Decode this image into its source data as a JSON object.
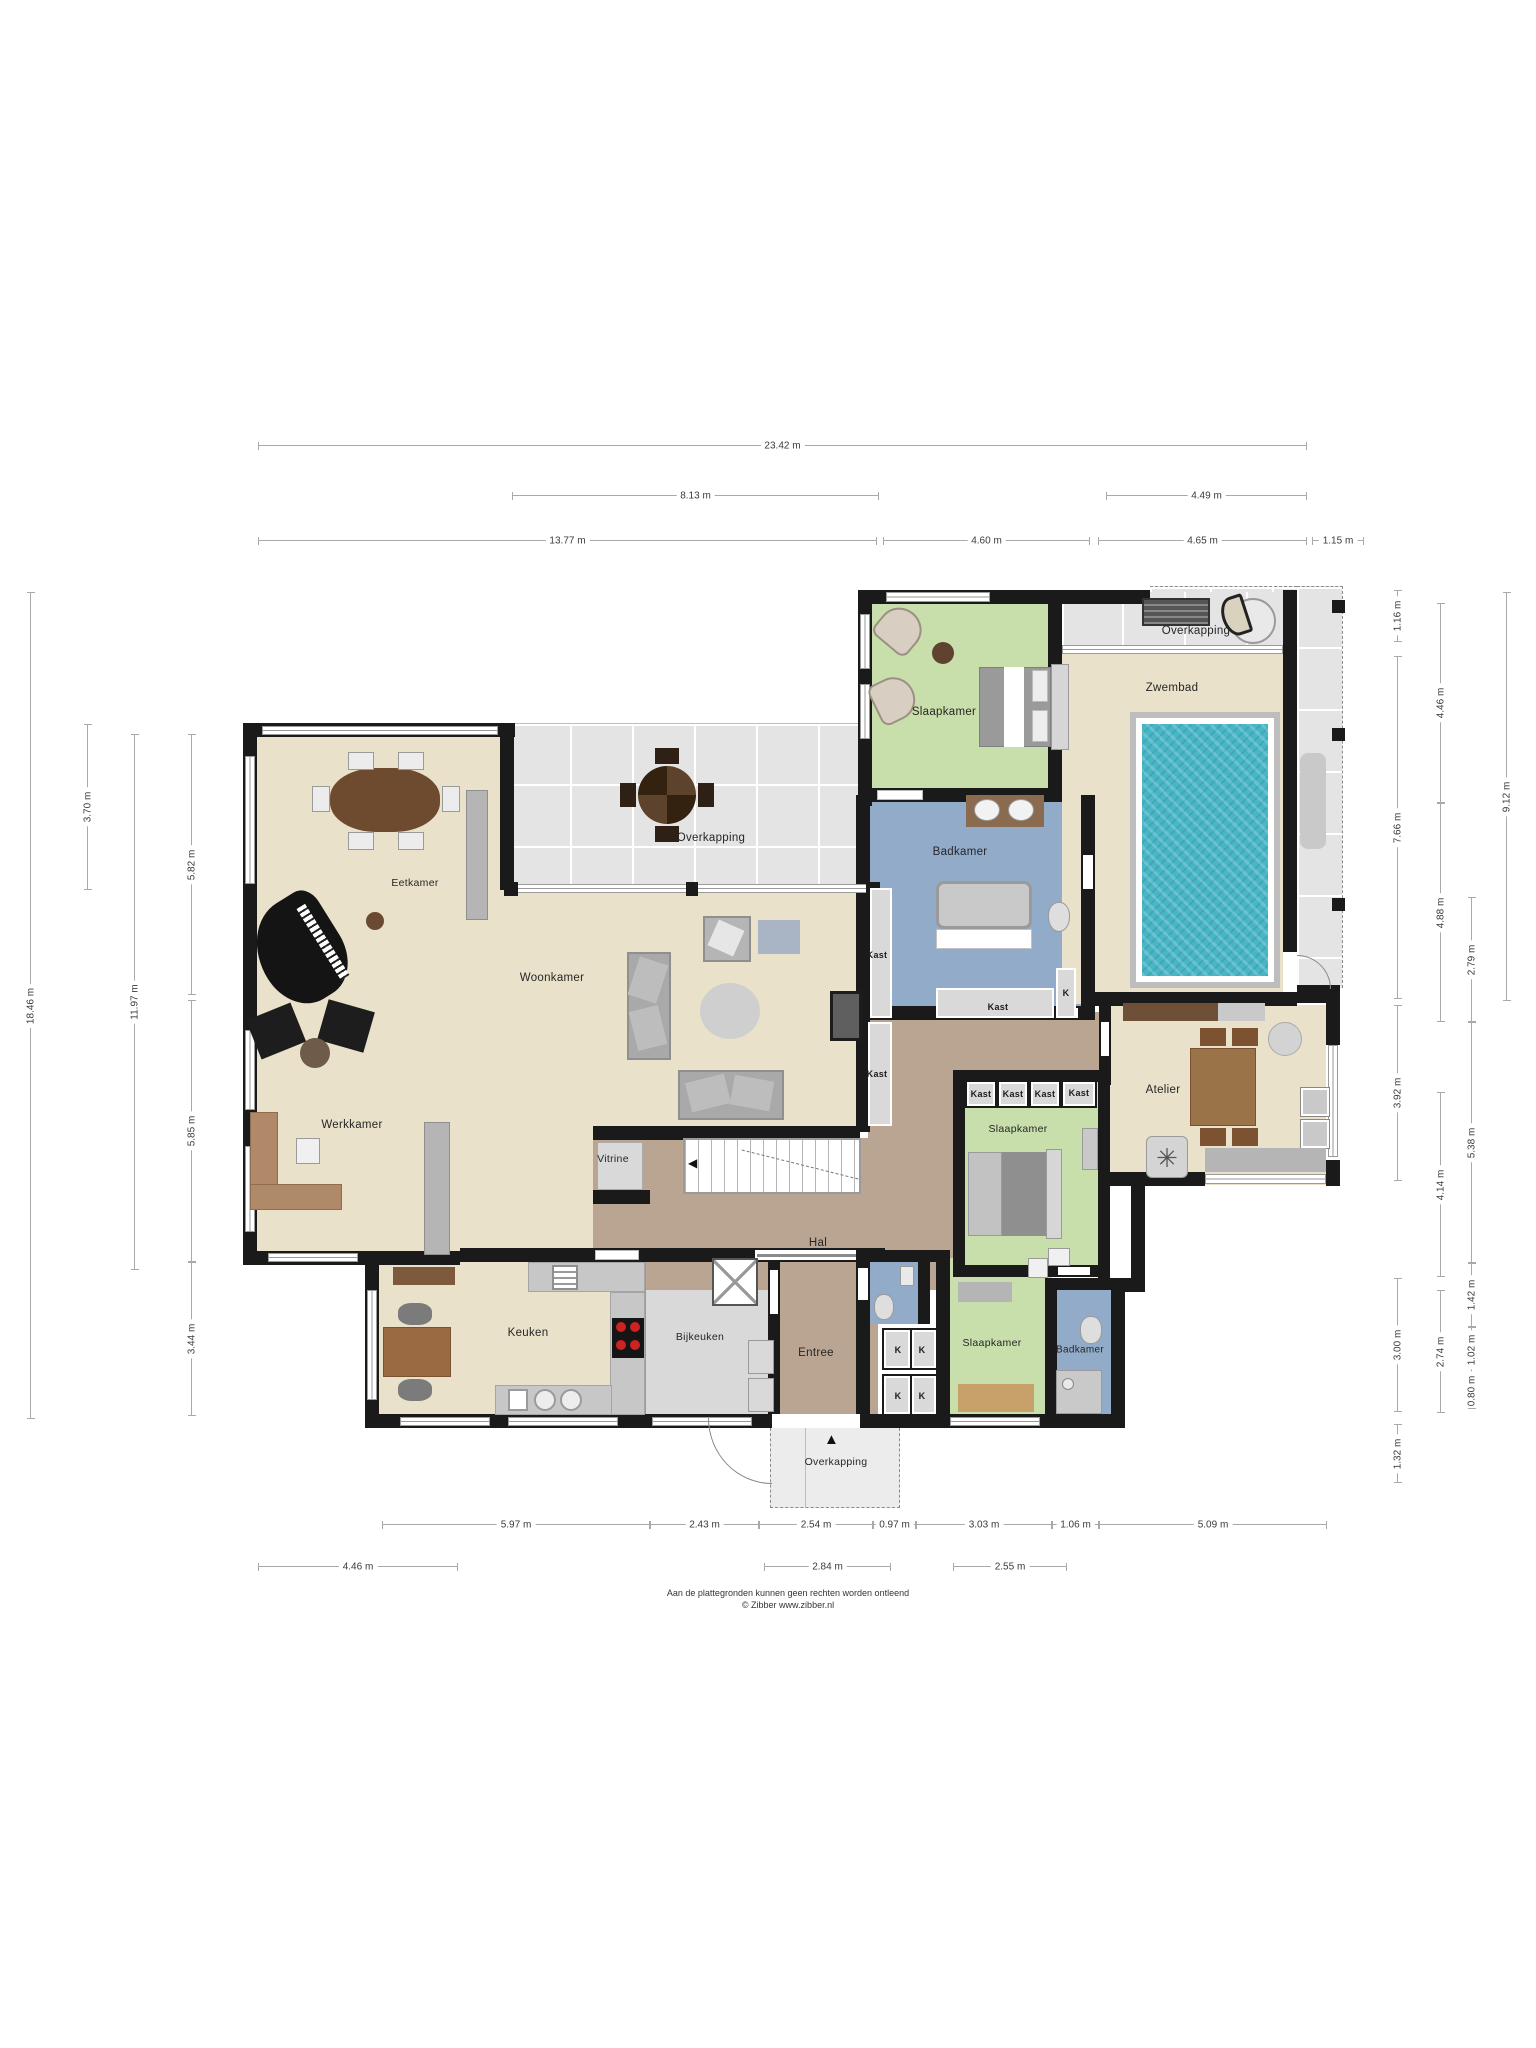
{
  "palette": {
    "wall": "#1a1a1a",
    "cream_floor": "#e9e1c9",
    "taupe_floor": "#b9a591",
    "green_room": "#c9dfab",
    "blue_room": "#92abc9",
    "grey_tile": "#e4e4e4",
    "pool_water": "#48b6c6",
    "counter_grey": "#c7c7c7",
    "dim_line": "#a9a9a9",
    "wood_dark": "#6e4a2e",
    "wood_mid": "#9a7448"
  },
  "footer": {
    "line1": "Aan de plattegronden kunnen geen rechten worden ontleend",
    "line2": "© Zibber www.zibber.nl"
  },
  "room_labels": [
    {
      "text": "Slaapkamer",
      "x": 944,
      "y": 712,
      "size": 11.5
    },
    {
      "text": "Overkapping",
      "x": 1196,
      "y": 631,
      "size": 11.5
    },
    {
      "text": "Zwembad",
      "x": 1172,
      "y": 688,
      "size": 11.5
    },
    {
      "text": "Badkamer",
      "x": 960,
      "y": 852,
      "size": 11.5
    },
    {
      "text": "Eetkamer",
      "x": 415,
      "y": 883,
      "size": 10.5
    },
    {
      "text": "Overkapping",
      "x": 711,
      "y": 838,
      "size": 11.5
    },
    {
      "text": "Woonkamer",
      "x": 552,
      "y": 978,
      "size": 11.5
    },
    {
      "text": "Werkkamer",
      "x": 352,
      "y": 1125,
      "size": 11.5
    },
    {
      "text": "Atelier",
      "x": 1163,
      "y": 1090,
      "size": 11.5
    },
    {
      "text": "Slaapkamer",
      "x": 1018,
      "y": 1129,
      "size": 10.5
    },
    {
      "text": "Vitrine",
      "x": 613,
      "y": 1159,
      "size": 10.5
    },
    {
      "text": "Hal",
      "x": 818,
      "y": 1243,
      "size": 11.5
    },
    {
      "text": "Keuken",
      "x": 528,
      "y": 1333,
      "size": 11.5
    },
    {
      "text": "Bijkeuken",
      "x": 700,
      "y": 1337,
      "size": 10.5
    },
    {
      "text": "Entree",
      "x": 816,
      "y": 1353,
      "size": 11.5
    },
    {
      "text": "Slaapkamer",
      "x": 992,
      "y": 1343,
      "size": 10.5
    },
    {
      "text": "Badkamer",
      "x": 1080,
      "y": 1350,
      "size": 10
    },
    {
      "text": "Overkapping",
      "x": 836,
      "y": 1462,
      "size": 10.5
    }
  ],
  "closet_labels": [
    {
      "text": "Kast",
      "x": 877,
      "y": 955
    },
    {
      "text": "Kast",
      "x": 877,
      "y": 1074
    },
    {
      "text": "Kast",
      "x": 998,
      "y": 1007
    },
    {
      "text": "K",
      "x": 1066,
      "y": 993
    },
    {
      "text": "Kast",
      "x": 981,
      "y": 1094
    },
    {
      "text": "Kast",
      "x": 1013,
      "y": 1094
    },
    {
      "text": "Kast",
      "x": 1045,
      "y": 1094
    },
    {
      "text": "Kast",
      "x": 1079,
      "y": 1093
    },
    {
      "text": "K",
      "x": 898,
      "y": 1350
    },
    {
      "text": "K",
      "x": 922,
      "y": 1350
    },
    {
      "text": "K",
      "x": 898,
      "y": 1396
    },
    {
      "text": "K",
      "x": 922,
      "y": 1396
    }
  ],
  "dimensions": {
    "horizontal": [
      {
        "label": "23.42 m",
        "x": 258,
        "y": 445,
        "w": 1049
      },
      {
        "label": "8.13 m",
        "x": 512,
        "y": 495,
        "w": 367
      },
      {
        "label": "4.49 m",
        "x": 1106,
        "y": 495,
        "w": 201
      },
      {
        "label": "13.77 m",
        "x": 258,
        "y": 540,
        "w": 619
      },
      {
        "label": "4.60 m",
        "x": 883,
        "y": 540,
        "w": 207
      },
      {
        "label": "4.65 m",
        "x": 1098,
        "y": 540,
        "w": 209
      },
      {
        "label": "1.15 m",
        "x": 1312,
        "y": 540,
        "w": 52
      },
      {
        "label": "5.97 m",
        "x": 382,
        "y": 1524,
        "w": 268
      },
      {
        "label": "2.43 m",
        "x": 650,
        "y": 1524,
        "w": 109
      },
      {
        "label": "2.54 m",
        "x": 759,
        "y": 1524,
        "w": 114
      },
      {
        "label": "0.97 m",
        "x": 873,
        "y": 1524,
        "w": 43
      },
      {
        "label": "3.03 m",
        "x": 916,
        "y": 1524,
        "w": 136
      },
      {
        "label": "1.06 m",
        "x": 1052,
        "y": 1524,
        "w": 47
      },
      {
        "label": "5.09 m",
        "x": 1099,
        "y": 1524,
        "w": 228
      },
      {
        "label": "4.46 m",
        "x": 258,
        "y": 1566,
        "w": 200
      },
      {
        "label": "2.84 m",
        "x": 764,
        "y": 1566,
        "w": 127
      },
      {
        "label": "2.55 m",
        "x": 953,
        "y": 1566,
        "w": 114
      }
    ],
    "vertical": [
      {
        "label": "18.46 m",
        "x": 30,
        "y": 592,
        "h": 827
      },
      {
        "label": "3.70 m",
        "x": 87,
        "y": 724,
        "h": 166
      },
      {
        "label": "11.97 m",
        "x": 134,
        "y": 734,
        "h": 536
      },
      {
        "label": "5.82 m",
        "x": 191,
        "y": 734,
        "h": 261
      },
      {
        "label": "5.85 m",
        "x": 191,
        "y": 1000,
        "h": 262
      },
      {
        "label": "3.44 m",
        "x": 191,
        "y": 1262,
        "h": 154
      },
      {
        "label": "1.16 m",
        "x": 1397,
        "y": 590,
        "h": 52
      },
      {
        "label": "7.66 m",
        "x": 1397,
        "y": 656,
        "h": 343
      },
      {
        "label": "3.92 m",
        "x": 1397,
        "y": 1005,
        "h": 176
      },
      {
        "label": "3.00 m",
        "x": 1397,
        "y": 1278,
        "h": 134
      },
      {
        "label": "1.32 m",
        "x": 1397,
        "y": 1424,
        "h": 59
      },
      {
        "label": "4.46 m",
        "x": 1440,
        "y": 603,
        "h": 200
      },
      {
        "label": "4.88 m",
        "x": 1440,
        "y": 803,
        "h": 219
      },
      {
        "label": "4.14 m",
        "x": 1440,
        "y": 1092,
        "h": 185
      },
      {
        "label": "2.74 m",
        "x": 1440,
        "y": 1290,
        "h": 123
      },
      {
        "label": "2.79 m",
        "x": 1471,
        "y": 897,
        "h": 125
      },
      {
        "label": "5.38 m",
        "x": 1471,
        "y": 1022,
        "h": 241
      },
      {
        "label": "1.42 m",
        "x": 1471,
        "y": 1263,
        "h": 64
      },
      {
        "label": "1.02 m",
        "x": 1471,
        "y": 1327,
        "h": 46
      },
      {
        "label": "0.80 m",
        "x": 1471,
        "y": 1373,
        "h": 36
      },
      {
        "label": "9.12 m",
        "x": 1506,
        "y": 592,
        "h": 409
      }
    ]
  }
}
